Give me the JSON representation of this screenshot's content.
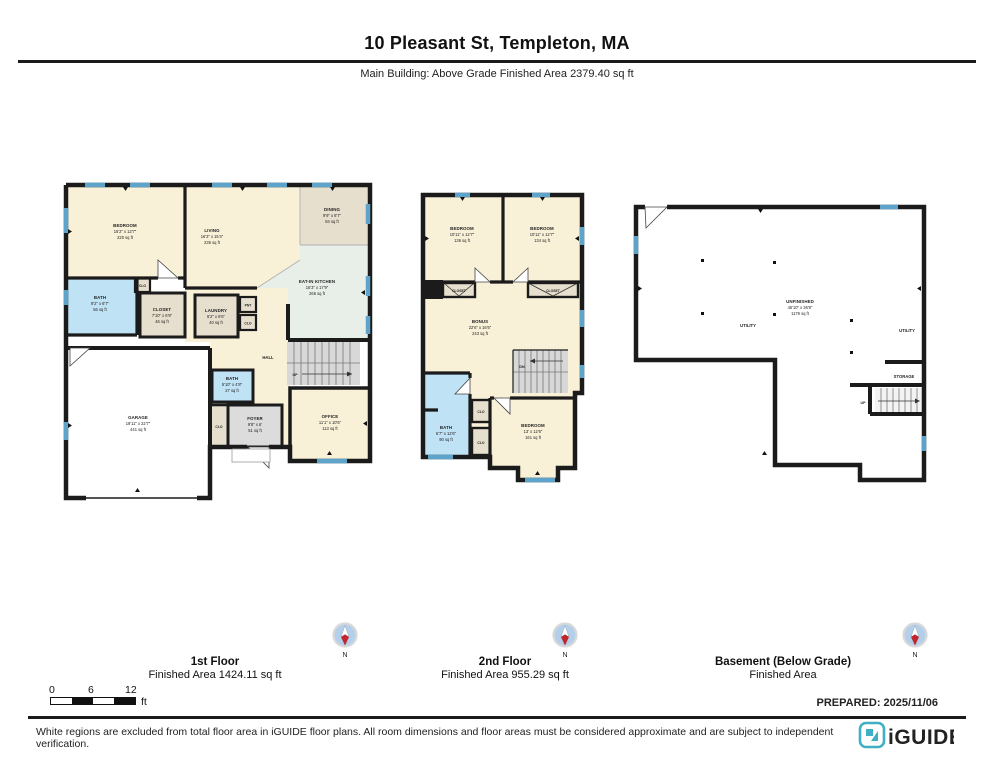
{
  "header": {
    "title": "10 Pleasant St, Templeton, MA",
    "subtitle": "Main Building: Above Grade Finished Area 2379.40 sq ft"
  },
  "compass": {
    "label": "N"
  },
  "scale": {
    "zero": "0",
    "six": "6",
    "twelve": "12",
    "unit": "ft"
  },
  "prepared": "PREPARED: 2025/11/06",
  "disclaimer": "White regions are excluded from total floor area in iGUIDE floor plans. All room dimensions and floor areas must be considered approximate and are subject to independent verification.",
  "brand": {
    "name": "iGUIDE"
  },
  "colors": {
    "wall": "#1b1b1b",
    "window": "#5ea3c9",
    "room_cream": "#f8f0d7",
    "room_tan": "#e7dfcd",
    "room_blue": "#bfe2f5",
    "room_green": "#e8efe9",
    "room_gray": "#dcdcdc",
    "brand_teal": "#3fafc4",
    "compass_blue": "#b3cfe9",
    "compass_red": "#c0272d"
  },
  "floors": [
    {
      "name": "1st Floor",
      "area_label": "Finished Area 1424.11 sq ft",
      "rooms": {
        "bedroom": {
          "name": "BEDROOM",
          "dims": "16'2\" x 13'7\"",
          "area": "220 sq ft"
        },
        "living": {
          "name": "LIVING",
          "dims": "16'3\" x 15'4\"",
          "area": "236 sq ft"
        },
        "dining": {
          "name": "DINING",
          "dims": "9'9\" x 8'7\"",
          "area": "84 sq ft"
        },
        "kitchen": {
          "name": "EAT-IN KITCHEN",
          "dims": "16'3\" x 17'9\"",
          "area": "266 sq ft"
        },
        "bath": {
          "name": "BATH",
          "dims": "9'2\" x 6'7\"",
          "area": "56 sq ft"
        },
        "closet": {
          "name": "CLOSET",
          "dims": "7'10\" x 6'9\"",
          "area": "46 sq ft"
        },
        "laundry": {
          "name": "LAUNDRY",
          "dims": "6'2\" x 6'6\"",
          "area": "40 sq ft"
        },
        "pantry": {
          "name": "PNT"
        },
        "clo_a": {
          "name": "CLO"
        },
        "clo_b": {
          "name": "CLO"
        },
        "clo_c": {
          "name": "CLO"
        },
        "hall": {
          "name": "HALL"
        },
        "stairs_up": {
          "name": "UP"
        },
        "bath2": {
          "name": "BATH",
          "dims": "5'10\" x 4'8\"",
          "area": "27 sq ft"
        },
        "foyer": {
          "name": "FOYER",
          "dims": "9'8\" x 6'",
          "area": "51 sq ft"
        },
        "office": {
          "name": "OFFICE",
          "dims": "11'1\" x 10'5\"",
          "area": "113 sq ft"
        },
        "garage": {
          "name": "GARAGE",
          "dims": "19'11\" x 22'7\"",
          "area": "441 sq ft"
        }
      }
    },
    {
      "name": "2nd Floor",
      "area_label": "Finished Area 955.29 sq ft",
      "rooms": {
        "bedroom_left": {
          "name": "BEDROOM",
          "dims": "10'11\" x 12'7\"",
          "area": "136 sq ft"
        },
        "bedroom_right": {
          "name": "BEDROOM",
          "dims": "10'11\" x 12'7\"",
          "area": "134 sq ft"
        },
        "closet_left": {
          "name": "CLOSET"
        },
        "closet_right": {
          "name": "CLOSET"
        },
        "bonus": {
          "name": "BONUS",
          "dims": "22'6\" x 16'6\"",
          "area": "243 sq ft"
        },
        "bath": {
          "name": "BATH",
          "dims": "6'7\" x 12'6\"",
          "area": "90 sq ft"
        },
        "clo_a": {
          "name": "CLO"
        },
        "clo_b": {
          "name": "CLO"
        },
        "bedroom_bottom": {
          "name": "BEDROOM",
          "dims": "13' x 12'6\"",
          "area": "161 sq ft"
        },
        "stairs_dn": {
          "name": "DN"
        }
      }
    },
    {
      "name": "Basement (Below Grade)",
      "area_label": "Finished Area",
      "rooms": {
        "unfinished": {
          "name": "UNFINISHED",
          "dims": "45'10\" x 36'8\"",
          "area": "1179 sq ft"
        },
        "utility_left": {
          "name": "UTILITY"
        },
        "utility_right": {
          "name": "UTILITY"
        },
        "storage": {
          "name": "STORAGE"
        },
        "stairs_up": {
          "name": "UP"
        }
      }
    }
  ]
}
